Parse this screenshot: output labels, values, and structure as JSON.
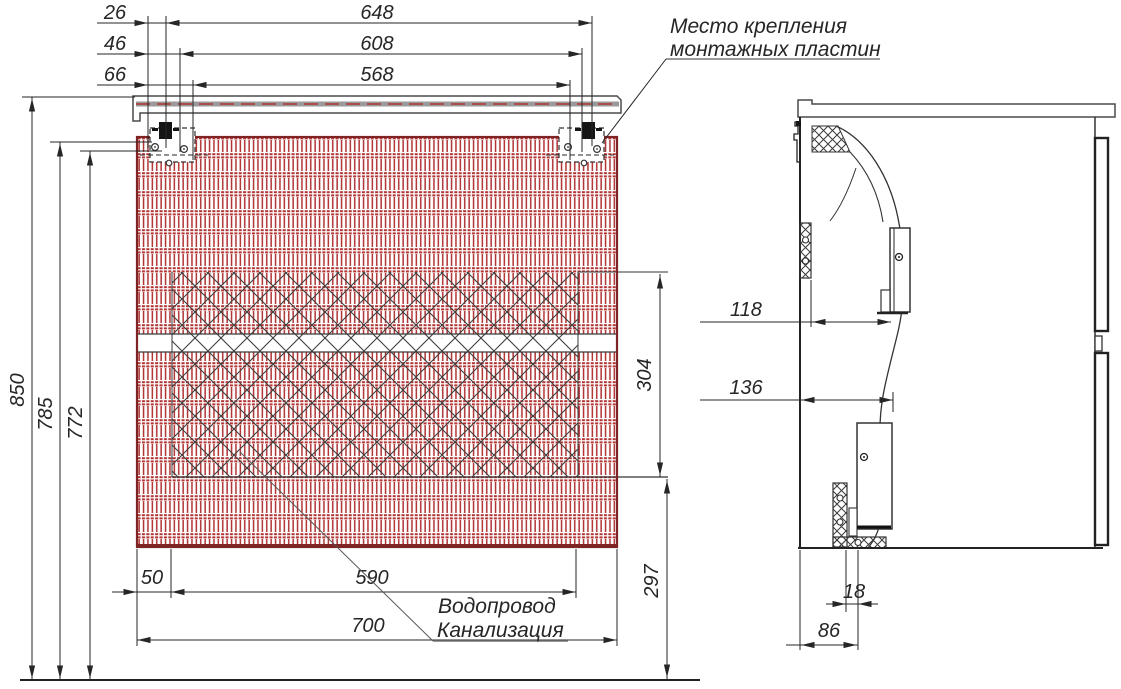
{
  "drawing": {
    "kind": "vanity-cabinet installation drawing",
    "views": {
      "front": "front view with wall-mount plates",
      "side": "side section view"
    }
  },
  "annotations": {
    "mounting": {
      "line1": "Место крепления",
      "line2": "монтажных пластин"
    },
    "plumbing": {
      "line1": "Водопровод",
      "line2": "Канализация"
    }
  },
  "dimensions": {
    "front_top": {
      "d26": "26",
      "d46": "46",
      "d66": "66",
      "d648": "648",
      "d608": "608",
      "d568": "568"
    },
    "front_left": {
      "d850": "850",
      "d785": "785",
      "d772": "772"
    },
    "front_bottom": {
      "d50": "50",
      "d590": "590",
      "d700": "700"
    },
    "front_right": {
      "d304": "304",
      "d297": "297"
    },
    "side": {
      "d118": "118",
      "d136": "136",
      "d18": "18",
      "d86": "86"
    }
  },
  "colors": {
    "hatch-red": "#b13434",
    "outline-red": "#7e2424",
    "ink": "#262626",
    "soft-gray": "#9a9a9a"
  }
}
